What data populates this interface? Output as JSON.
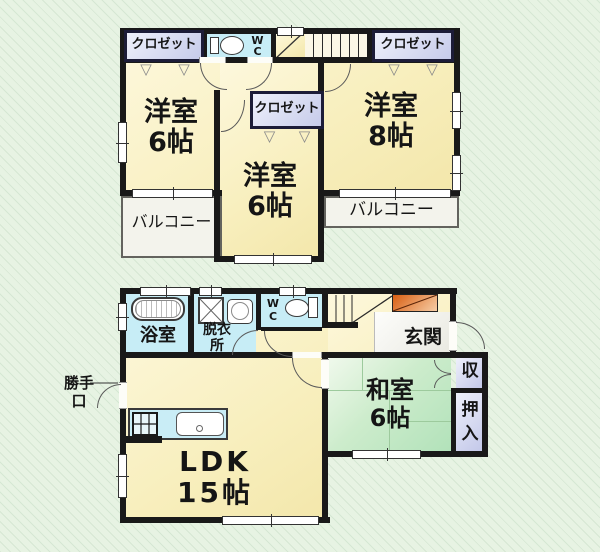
{
  "floor2": {
    "closet_left": {
      "label": "クロゼット"
    },
    "closet_right": {
      "label": "クロゼット"
    },
    "closet_center": {
      "label": "クロゼット"
    },
    "wc": {
      "line1": "W",
      "line2": "C"
    },
    "room_nw": {
      "name": "洋室",
      "size": "6帖"
    },
    "room_ne": {
      "name": "洋室",
      "size": "8帖"
    },
    "room_center": {
      "name": "洋室",
      "size": "6帖"
    },
    "balcony_left": {
      "label": "バルコニー"
    },
    "balcony_right": {
      "label": "バルコニー"
    }
  },
  "floor1": {
    "bath": {
      "label": "浴室"
    },
    "dressing": {
      "line1": "脱衣",
      "line2": "所"
    },
    "wc": {
      "line1": "W",
      "line2": "C"
    },
    "entrance": {
      "label": "玄関"
    },
    "storage": {
      "label": "収"
    },
    "oshiire": {
      "line1": "押",
      "line2": "入"
    },
    "washitsu": {
      "name": "和室",
      "size": "6帖"
    },
    "ldk": {
      "name": "LDK",
      "size": "15帖"
    },
    "back_door": {
      "line1": "勝手",
      "line2": "口"
    }
  },
  "colors": {
    "wall": "#191919",
    "room_cream": "#f8efbe",
    "wet_blue": "#c7edf6",
    "closet_lavender": "#c6cbea",
    "tatami_green": "#b2e2ba",
    "balcony_gray": "#f3f3ec",
    "shoe_cabinet_orange": "#d95f12",
    "background_green": "#e7f3e3"
  }
}
